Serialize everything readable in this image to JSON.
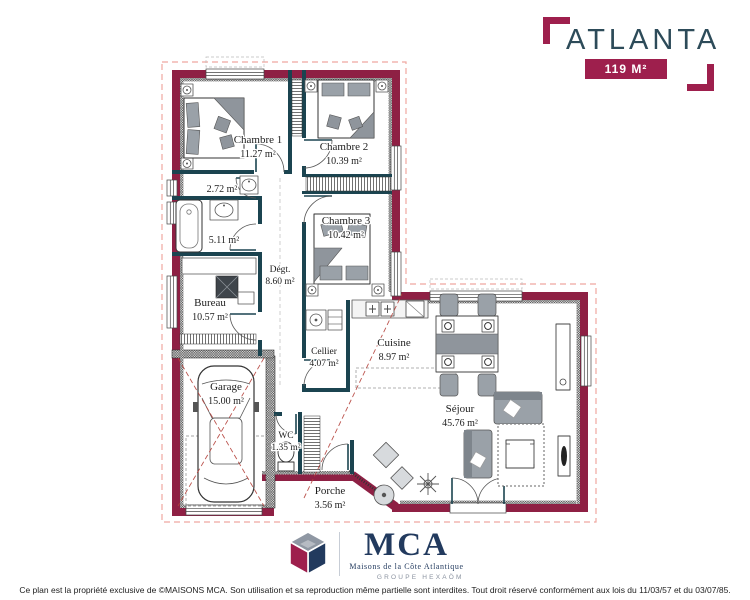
{
  "header": {
    "project_title": "ATLANTA",
    "area_badge": "119 M²"
  },
  "rooms": [
    {
      "id": "chambre-1",
      "name": "Chambre 1",
      "area": "11.27 m²"
    },
    {
      "id": "chambre-2",
      "name": "Chambre 2",
      "area": "10.39 m²"
    },
    {
      "id": "chambre-3",
      "name": "Chambre 3",
      "area": "10.42 m²"
    },
    {
      "id": "salle-eau",
      "name": "",
      "area": "2.72 m²"
    },
    {
      "id": "salle-bains",
      "name": "",
      "area": "5.11 m²"
    },
    {
      "id": "bureau",
      "name": "Bureau",
      "area": "10.57 m²"
    },
    {
      "id": "degagement",
      "name": "Dégt.",
      "area": "8.60 m²"
    },
    {
      "id": "cellier",
      "name": "Cellier",
      "area": "4.07 m²"
    },
    {
      "id": "cuisine",
      "name": "Cuisine",
      "area": "8.97 m²"
    },
    {
      "id": "garage",
      "name": "Garage",
      "area": "15.00 m²"
    },
    {
      "id": "wc",
      "name": "WC",
      "area": "1.35 m²"
    },
    {
      "id": "porche",
      "name": "Porche",
      "area": "3.56 m²"
    },
    {
      "id": "sejour",
      "name": "Séjour",
      "area": "45.76 m²"
    }
  ],
  "footer": {
    "logo_acronym": "MCA",
    "logo_name": "Maisons de la Côte Atlantique",
    "logo_group": "GROUPE HEXAÖM",
    "copyright": "Ce plan est la propriété exclusive de ©MAISONS MCA. Son utilisation et sa reproduction même partielle sont interdites. Tout droit réservé conformément aux lois du 11/03/57 et du 03/07/85."
  },
  "colors": {
    "wall_exterior": "#8E2044",
    "wall_interior": "#1B4450",
    "accent": "#9E1F4D",
    "title": "#2D4B59",
    "roof_outline": "#EFA8A0",
    "ridge_line": "#B5433C",
    "logo_navy": "#223A5E"
  }
}
